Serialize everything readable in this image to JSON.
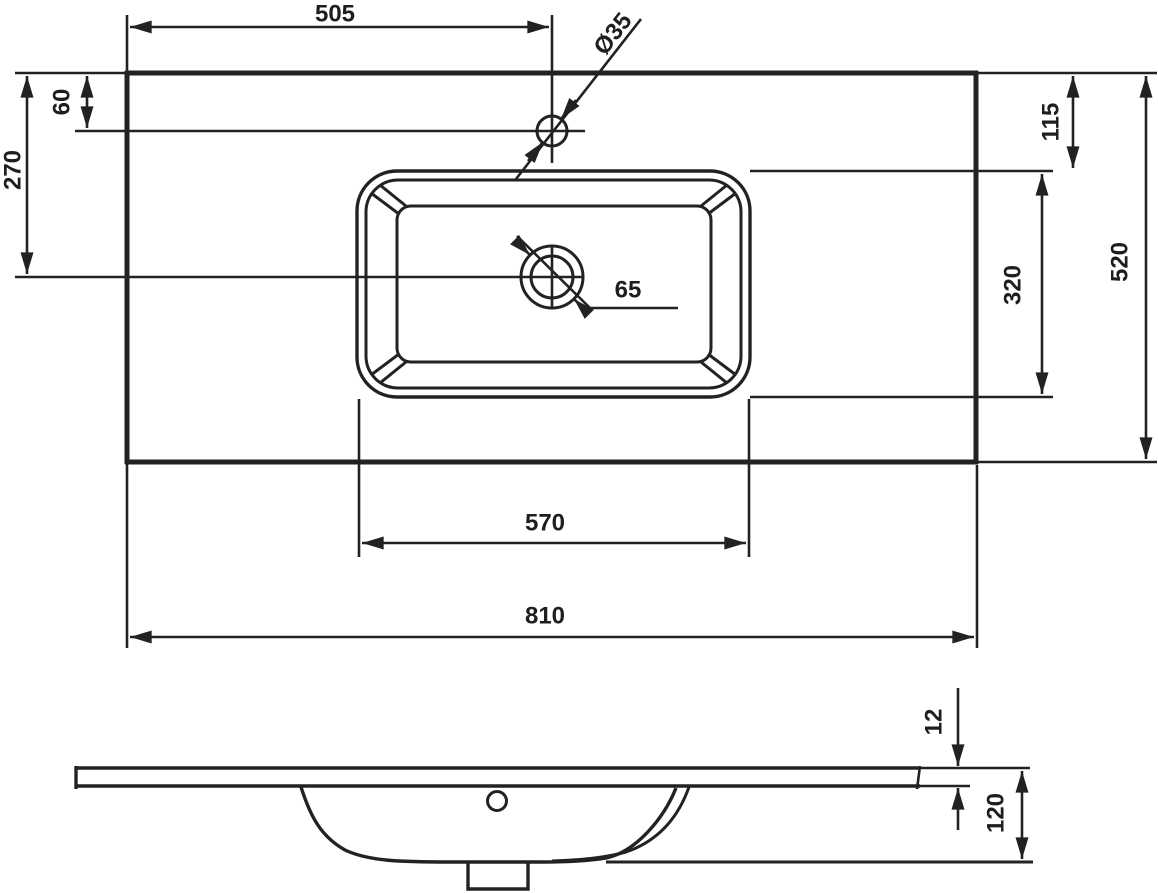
{
  "diagram": {
    "type": "technical-drawing",
    "subject": "washbasin-with-countertop",
    "background": "#ffffff",
    "line_color": "#222222",
    "views": {
      "top": {
        "name": "plan-view",
        "labels": {
          "dim505": "505",
          "dia35": "Ø35",
          "dim60": "60",
          "dim270": "270",
          "dim115": "115",
          "dim320": "320",
          "dim520": "520",
          "dim65": "65",
          "dim570": "570",
          "dim810": "810"
        }
      },
      "front": {
        "name": "front-elevation",
        "labels": {
          "dim12": "12",
          "dim120": "120"
        }
      }
    },
    "dimension_values": [
      505,
      35,
      60,
      270,
      115,
      320,
      520,
      65,
      570,
      810,
      12,
      120
    ]
  }
}
